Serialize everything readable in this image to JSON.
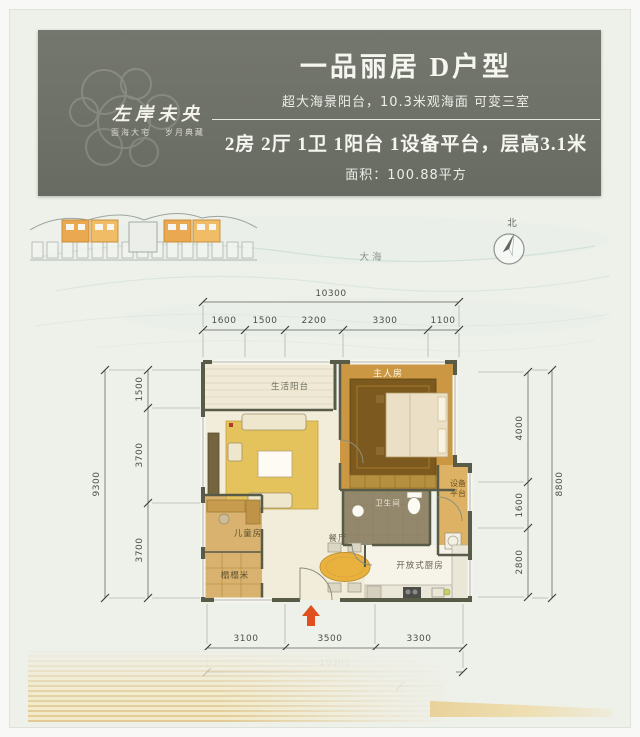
{
  "header": {
    "logo_title": "左岸未央",
    "logo_tagline_left": "面海大宅",
    "logo_tagline_right": "岁月典藏",
    "title": "一品丽居 D户型",
    "subtitle": "超大海景阳台，10.3米观海面 可变三室",
    "spec_line": "2房 2厅 1卫 1阳台 1设备平台，层高3.1米",
    "area_line": "面积：100.88平方"
  },
  "compass": {
    "north_label": "北"
  },
  "environment": {
    "sea_label": "大海"
  },
  "rooms": {
    "living_balcony": "生活阳台",
    "master_bedroom": "主人房",
    "equipment_platform": "设备平台",
    "bathroom": "卫生间",
    "children_room": "儿童房",
    "tatami": "榻榻米",
    "dining_room": "餐厅",
    "open_kitchen": "开放式厨房"
  },
  "dimensions": {
    "top_total": "10300",
    "top_segments": [
      "1600",
      "1500",
      "2200",
      "3300",
      "1100"
    ],
    "left_total": "9300",
    "left_segments": [
      "1500",
      "3700",
      "3700"
    ],
    "right_total": "8800",
    "right_segments": [
      "4000",
      "1600",
      "2800"
    ],
    "bottom_segments": [
      "3100",
      "3500",
      "3300"
    ],
    "bottom_total": "10300"
  },
  "colors": {
    "header_bg": "#70736a",
    "wall": "#575b47",
    "master_floor": "#cb9742",
    "rug_gold": "#e4c25c",
    "entry_arrow": "#e0501e",
    "highlight_unit": "#eaa850"
  }
}
